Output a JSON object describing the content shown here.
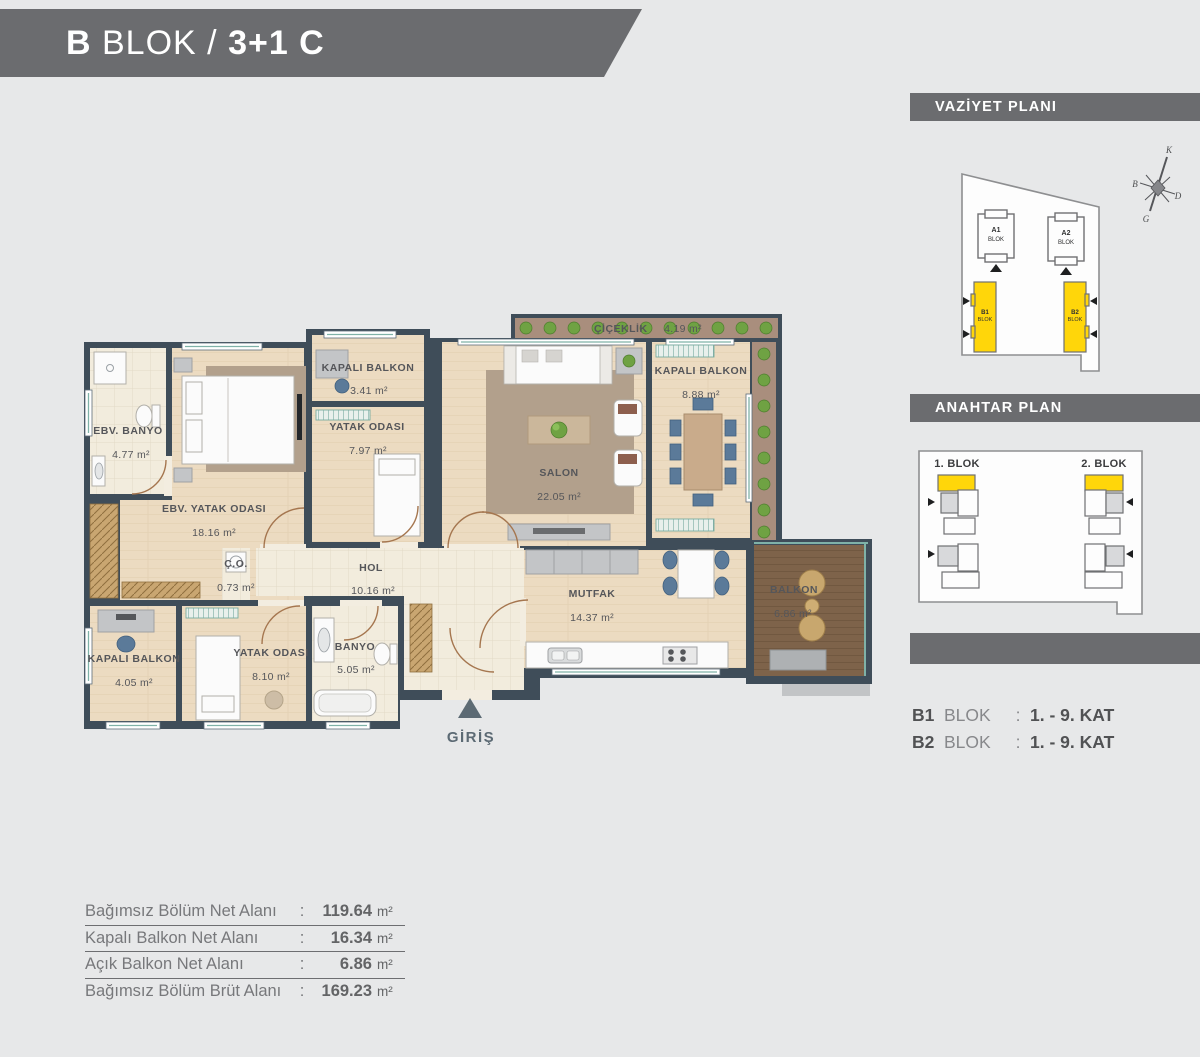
{
  "header": {
    "prefix": "B",
    "middle": " BLOK / ",
    "suffix": "3+1 C"
  },
  "site_plan": {
    "title": "VAZİYET PLANI",
    "compass": {
      "north": "K",
      "west": "B",
      "east": "D",
      "south": "G"
    },
    "blocks": {
      "a1": {
        "code": "A1",
        "label": "BLOK"
      },
      "a2": {
        "code": "A2",
        "label": "BLOK"
      },
      "b1": {
        "code": "B1",
        "label": "BLOK"
      },
      "b2": {
        "code": "B2",
        "label": "BLOK"
      }
    }
  },
  "key_plan": {
    "title": "ANAHTAR PLAN",
    "block1_label": "1. BLOK",
    "block2_label": "2. BLOK"
  },
  "floors": {
    "b1": {
      "code": "B1",
      "word": "BLOK",
      "colon": ":",
      "range": "1. - 9. KAT"
    },
    "b2": {
      "code": "B2",
      "word": "BLOK",
      "colon": ":",
      "range": "1. - 9. KAT"
    }
  },
  "plan": {
    "rooms": {
      "ebv_banyo": {
        "name": "EBV. BANYO",
        "area": "4.77 m²"
      },
      "ebv_yatak": {
        "name": "EBV. YATAK ODASI",
        "area": "18.16 m²"
      },
      "kapali_balkon_ust": {
        "name": "KAPALI BALKON",
        "area": "3.41 m²"
      },
      "yatak_odasi_ust": {
        "name": "YATAK ODASI",
        "area": "7.97 m²"
      },
      "salon": {
        "name": "SALON",
        "area": "22.05 m²"
      },
      "kapali_balkon_sag": {
        "name": "KAPALI BALKON",
        "area": "8.88 m²"
      },
      "ciceklik": {
        "name": "ÇİÇEKLİK",
        "area": "4.19 m²"
      },
      "hol": {
        "name": "HOL",
        "area": "10.16 m²"
      },
      "co": {
        "name": "Ç.O.",
        "area": "0.73 m²"
      },
      "mutfak": {
        "name": "MUTFAK",
        "area": "14.37 m²"
      },
      "balkon": {
        "name": "BALKON",
        "area": "6.86 m²"
      },
      "kapali_balkon_alt": {
        "name": "KAPALI BALKON",
        "area": "4.05 m²"
      },
      "yatak_odasi_alt": {
        "name": "YATAK ODASI",
        "area": "8.10 m²"
      },
      "banyo": {
        "name": "BANYO",
        "area": "5.05 m²"
      }
    },
    "entrance_label": "GİRİŞ"
  },
  "areas_table": {
    "rows": [
      {
        "label": "Bağımsız Bölüm Net Alanı",
        "colon": ":",
        "value": "119.64",
        "unit": "m²"
      },
      {
        "label": "Kapalı Balkon Net Alanı",
        "colon": ":",
        "value": "16.34",
        "unit": "m²"
      },
      {
        "label": "Açık Balkon Net Alanı",
        "colon": ":",
        "value": "6.86",
        "unit": "m²"
      },
      {
        "label": "Bağımsız Bölüm Brüt Alanı",
        "colon": ":",
        "value": "169.23",
        "unit": "m²"
      }
    ]
  },
  "colors": {
    "highlight_yellow": "#ffd60a",
    "wall": "#3f4d59",
    "plant_green": "#6fa243"
  }
}
